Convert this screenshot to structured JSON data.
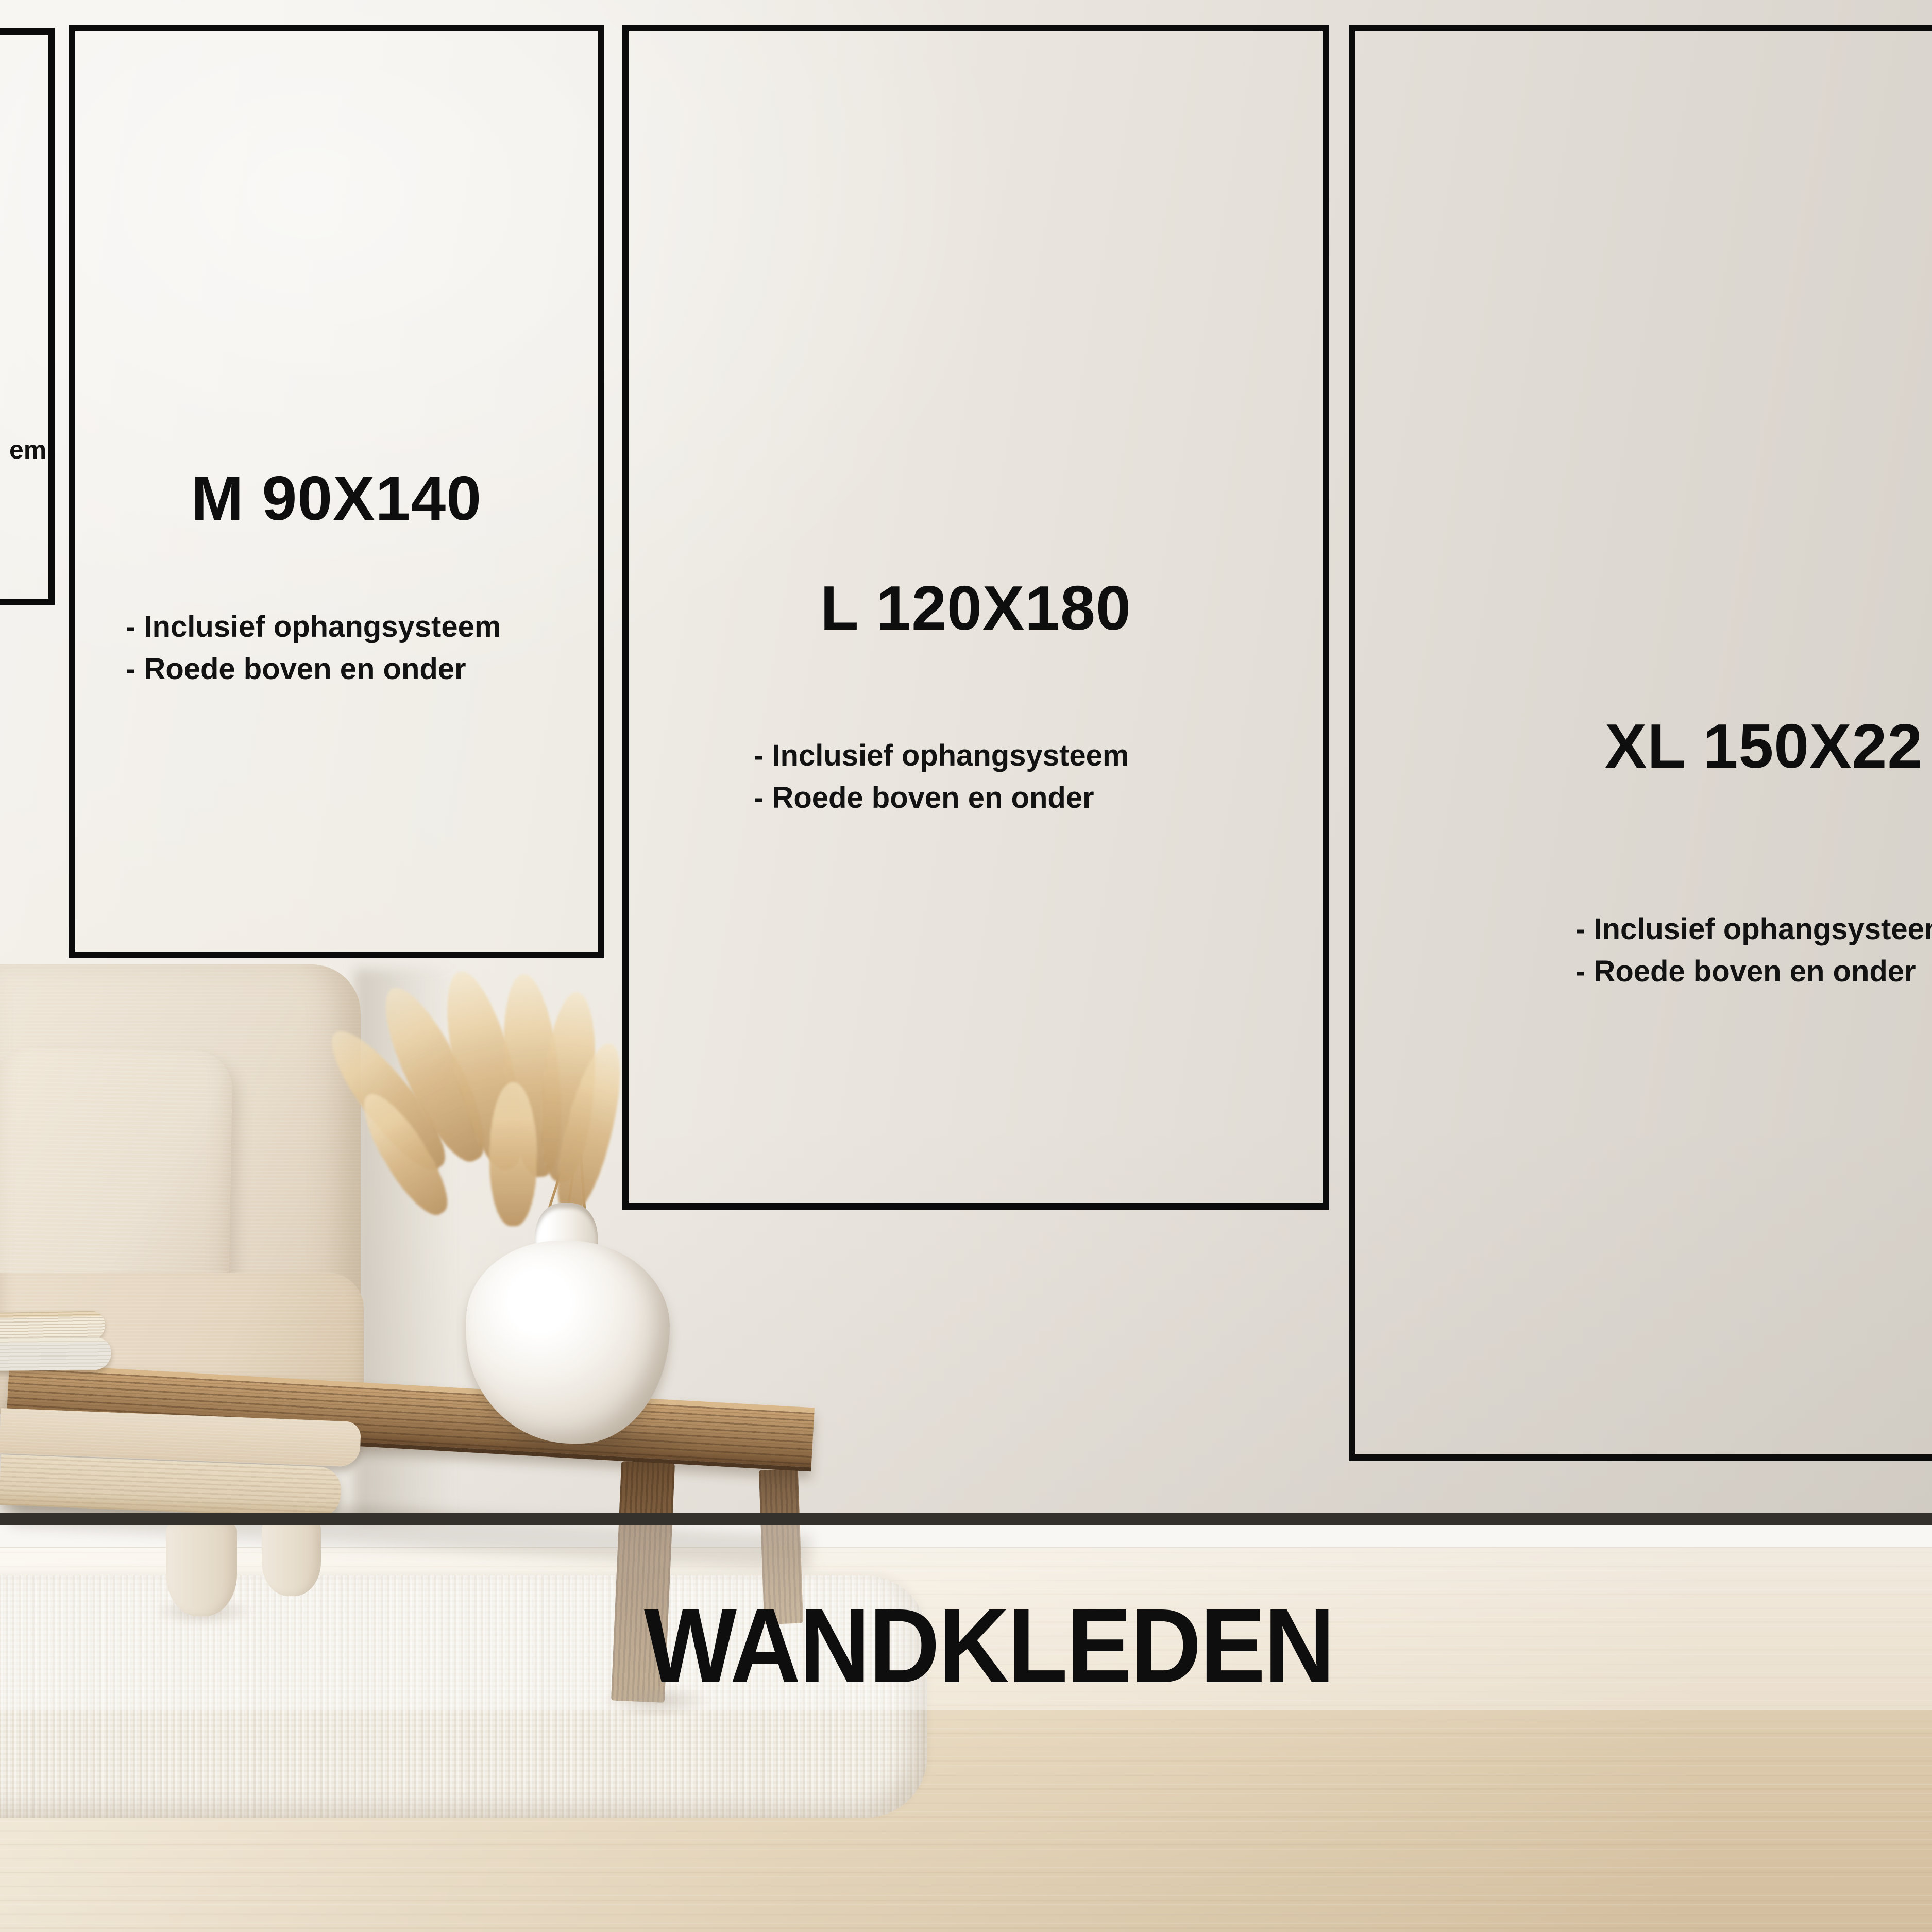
{
  "page": {
    "kind": "product-size-guide-poster",
    "language": "nl"
  },
  "footer": {
    "title": "WANDKLEDEN"
  },
  "cards": {
    "s": {
      "bullet_fragment": "em"
    },
    "m": {
      "title": "M 90X140",
      "bullets": [
        "- Inclusief ophangsysteem",
        "- Roede boven en onder"
      ]
    },
    "l": {
      "title": "L 120X180",
      "bullets": [
        "- Inclusief ophangsysteem",
        "- Roede boven en onder"
      ]
    },
    "xl": {
      "title": "XL 150X22",
      "bullets": [
        "- Inclusief ophangsysteem",
        "- Roede boven en onder"
      ]
    }
  },
  "scene": {
    "elements": [
      "sofa",
      "throw-pillow",
      "pampas-grass",
      "white-vase",
      "wooden-bench-table",
      "books",
      "white-rug",
      "wood-floor",
      "baseboard"
    ]
  },
  "colors": {
    "outline": "#0b0b0b",
    "text": "#0e0e0e",
    "wall_light": "#f5f3ef",
    "wall_dark": "#d5d0c8",
    "floor_line": "#34312c",
    "baseboard": "#f6f3ee",
    "floor": "#e3d2b5",
    "rug": "#f3efe6",
    "sofa": "#e7dccb",
    "wood": "#8a6843",
    "pampas": "#d1ac76"
  }
}
